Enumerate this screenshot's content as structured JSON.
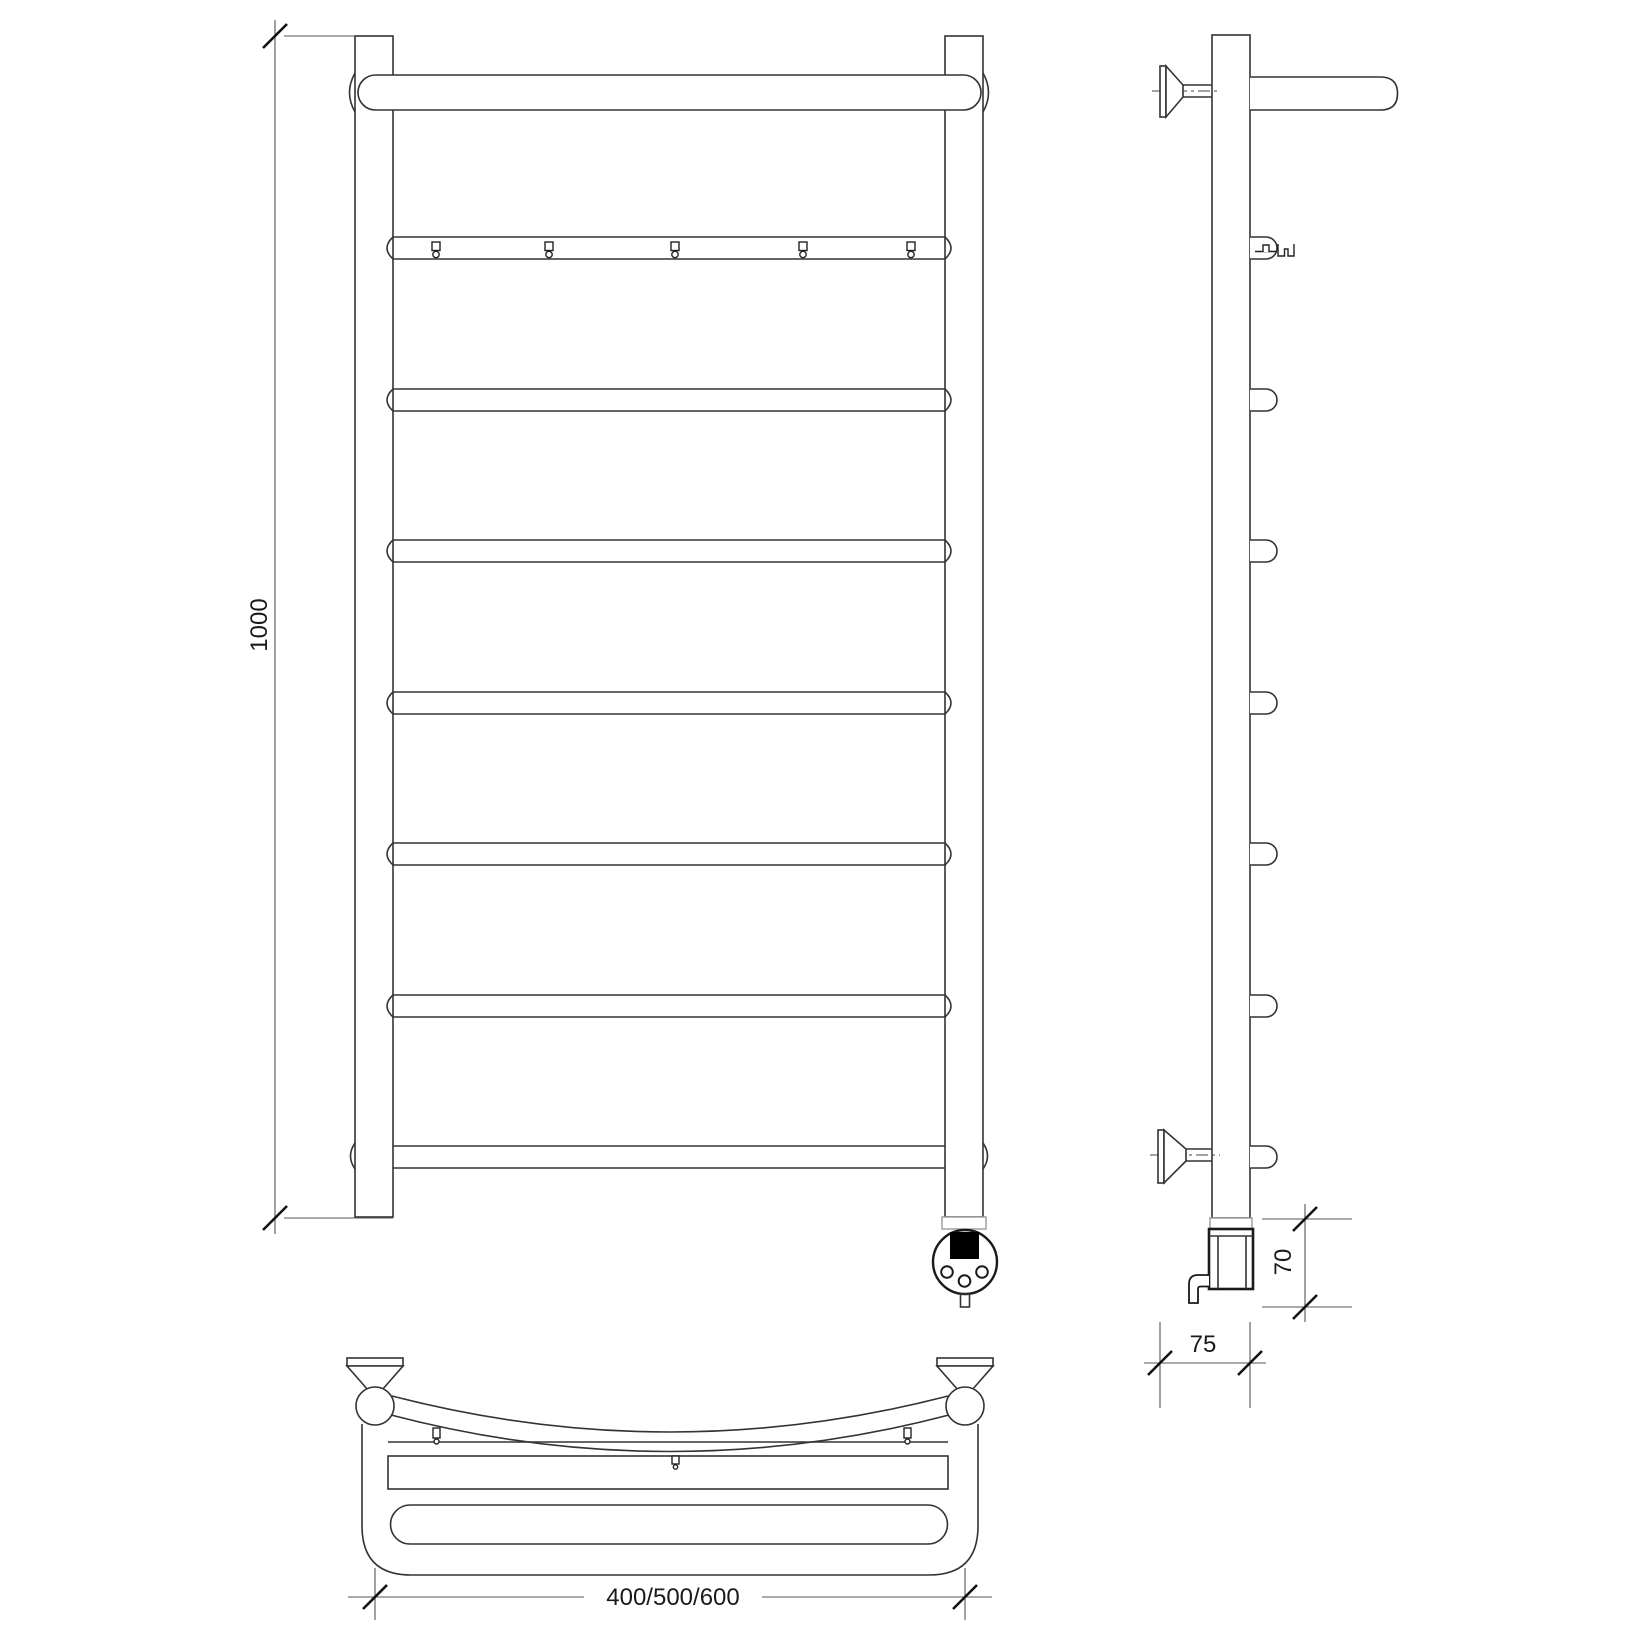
{
  "drawing": {
    "dimensions": {
      "height": "1000",
      "width_options": "400/500/600",
      "depth": "75",
      "element_height": "70"
    },
    "counts": {
      "rungs": 7,
      "hanger_hooks": 5,
      "side_rung_stubs": 7
    },
    "colors": {
      "line": "#333333",
      "dimension_line": "#555555",
      "background": "#ffffff",
      "display_fill": "#000000",
      "collar_line": "#999999"
    }
  }
}
